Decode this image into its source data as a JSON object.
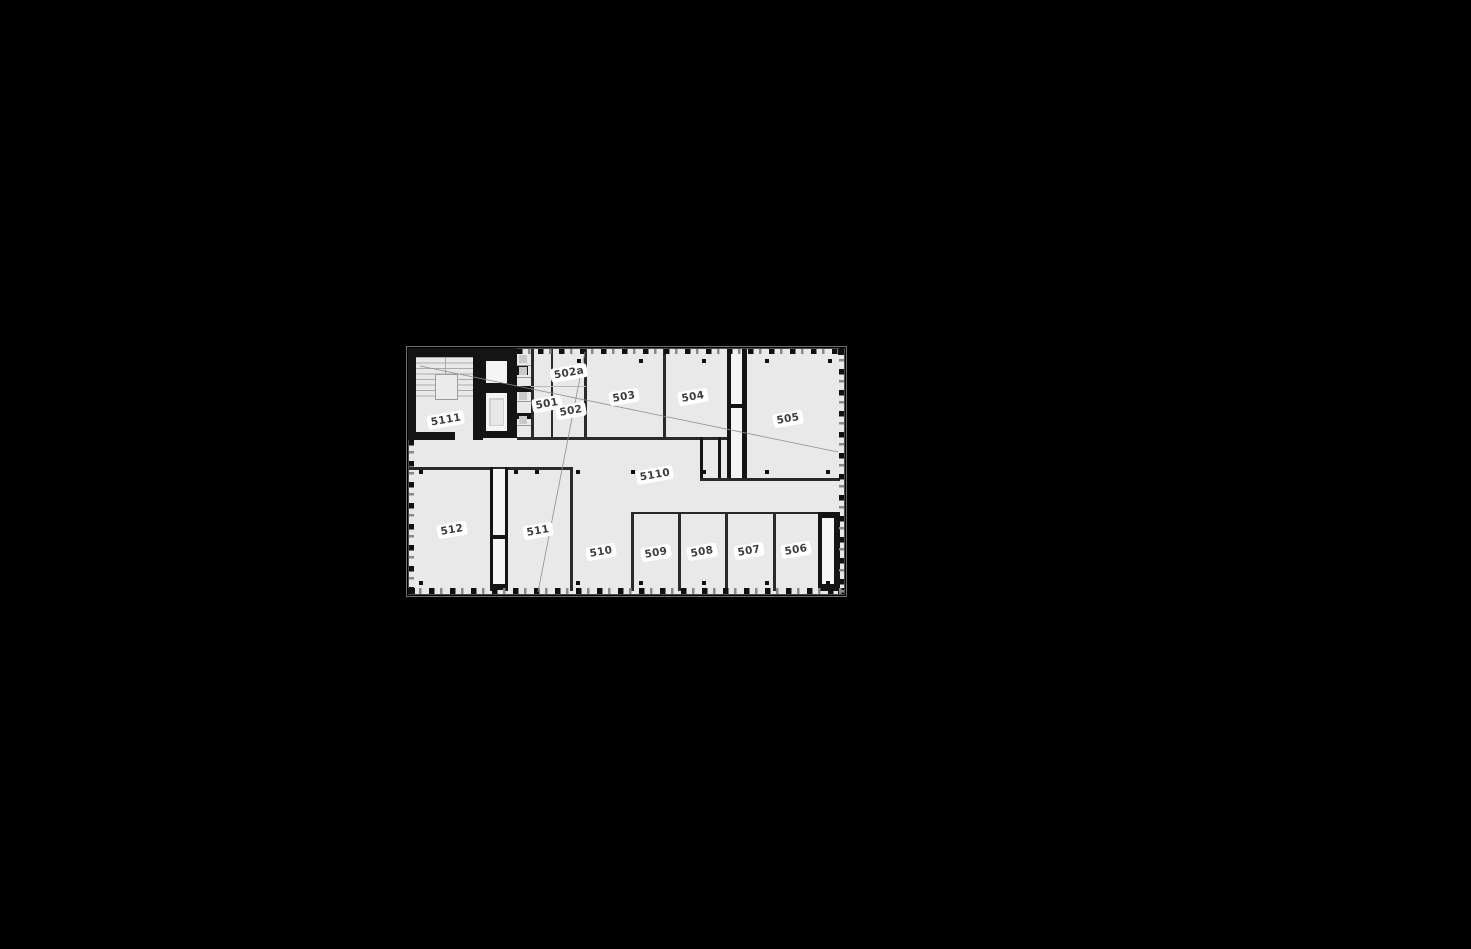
{
  "figure_type": "architectural-floor-plan",
  "rooms": [
    {
      "label": "5111"
    },
    {
      "label": "501"
    },
    {
      "label": "502"
    },
    {
      "label": "502a"
    },
    {
      "label": "503"
    },
    {
      "label": "504"
    },
    {
      "label": "505"
    },
    {
      "label": "5110"
    },
    {
      "label": "506"
    },
    {
      "label": "507"
    },
    {
      "label": "508"
    },
    {
      "label": "509"
    },
    {
      "label": "510"
    },
    {
      "label": "511"
    },
    {
      "label": "512"
    }
  ],
  "colors": {
    "page_background": "#000000",
    "floor": "#e9e9e9",
    "wall": "#141414",
    "thin_wall": "#2a2a2a",
    "label_text": "#3d3d3d",
    "label_background": "#ffffff"
  }
}
